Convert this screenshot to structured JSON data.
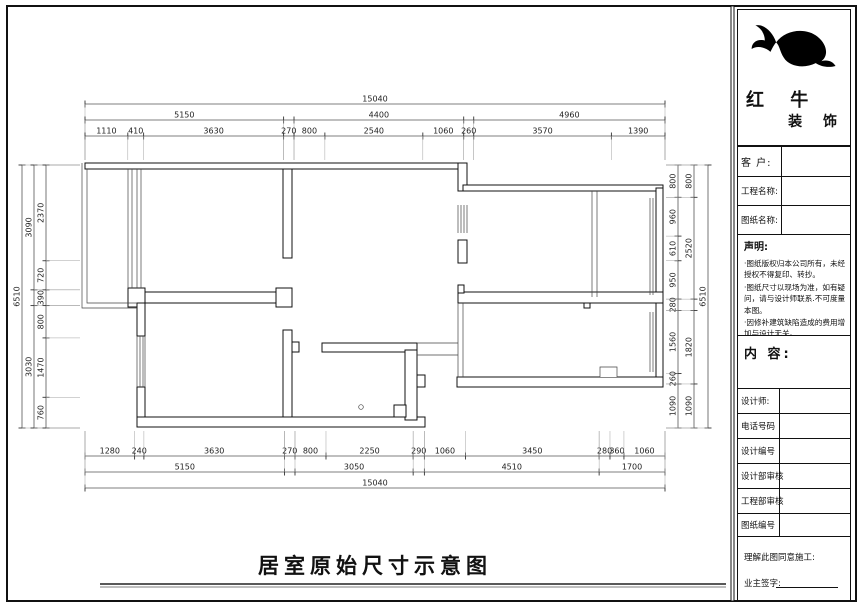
{
  "brand": {
    "line1": "红 牛",
    "line2": "装 饰"
  },
  "drawing_title": "居室原始尺寸示意图",
  "title_block": {
    "client_label": "客  户:",
    "project_label": "工程名称:",
    "drawing_label": "图纸名称:",
    "statement_heading": "声明:",
    "statement_items": [
      "·图纸版权归本公司所有，未经授权不得复印、转抄。",
      "·图纸尺寸以现场为准，如有疑问，请与设计师联系.不可度量本图。",
      "·因修补建筑缺陷造成的费用增加与设计无关。"
    ],
    "content_heading": "内 容:",
    "designer_label": "设计师:",
    "phone_label": "电话号码",
    "design_no_label": "设计编号",
    "design_review_label": "设计部审核",
    "engineering_review_label": "工程部审核",
    "drawing_no_label": "图纸编号",
    "signoff_line": "理解此图同意施工:",
    "owner_sign_label": "业主签字:"
  },
  "plan_dimensions": {
    "unit": "mm",
    "total_width": 15040,
    "total_height": 6510,
    "top": {
      "overall": [
        {
          "len": 15040,
          "label": "15040"
        }
      ],
      "groups": [
        {
          "len": 5150,
          "label": "5150"
        },
        {
          "len": 270,
          "label": ""
        },
        {
          "len": 4400,
          "label": "4400"
        },
        {
          "len": 260,
          "label": ""
        },
        {
          "len": 4960,
          "label": "4960"
        }
      ],
      "detail": [
        {
          "len": 1110,
          "label": "1110"
        },
        {
          "len": 410,
          "label": "410"
        },
        {
          "len": 3630,
          "label": "3630"
        },
        {
          "len": 270,
          "label": "270"
        },
        {
          "len": 800,
          "label": "800"
        },
        {
          "len": 2540,
          "label": "2540"
        },
        {
          "len": 1060,
          "label": "1060"
        },
        {
          "len": 260,
          "label": "260"
        },
        {
          "len": 3570,
          "label": "3570"
        },
        {
          "len": 1390,
          "label": "1390"
        }
      ]
    },
    "bottom": {
      "detail": [
        {
          "len": 1280,
          "label": "1280"
        },
        {
          "len": 240,
          "label": "240"
        },
        {
          "len": 3630,
          "label": "3630"
        },
        {
          "len": 270,
          "label": "270"
        },
        {
          "len": 800,
          "label": "800"
        },
        {
          "len": 2250,
          "label": "2250"
        },
        {
          "len": 290,
          "label": "290"
        },
        {
          "len": 1060,
          "label": "1060"
        },
        {
          "len": 3450,
          "label": "3450"
        },
        {
          "len": 280,
          "label": "280"
        },
        {
          "len": 360,
          "label": "360"
        },
        {
          "len": 1060,
          "label": "1060"
        }
      ],
      "groups": [
        {
          "len": 5150,
          "label": "5150"
        },
        {
          "len": 270,
          "label": ""
        },
        {
          "len": 3050,
          "label": "3050"
        },
        {
          "len": 290,
          "label": ""
        },
        {
          "len": 4510,
          "label": "4510"
        },
        {
          "len": 1700,
          "label": "1700"
        }
      ],
      "overall": [
        {
          "len": 14970,
          "label": "15040"
        }
      ]
    },
    "left": {
      "overall": [
        {
          "len": 6510,
          "label": "6510"
        }
      ],
      "groups": [
        {
          "len": 3090,
          "label": "3090"
        },
        {
          "len": 390,
          "label": ""
        },
        {
          "len": 3030,
          "label": "3030"
        }
      ],
      "detail": [
        {
          "len": 2370,
          "label": "2370"
        },
        {
          "len": 720,
          "label": "720"
        },
        {
          "len": 390,
          "label": "390"
        },
        {
          "len": 800,
          "label": "800"
        },
        {
          "len": 1470,
          "label": "1470"
        },
        {
          "len": 760,
          "label": "760"
        }
      ]
    },
    "right": {
      "detail": [
        {
          "len": 800,
          "label": "800"
        },
        {
          "len": 960,
          "label": "960"
        },
        {
          "len": 610,
          "label": "610"
        },
        {
          "len": 950,
          "label": "950"
        },
        {
          "len": 280,
          "label": "280"
        },
        {
          "len": 1560,
          "label": "1560"
        },
        {
          "len": 260,
          "label": "260"
        },
        {
          "len": 1090,
          "label": "1090"
        }
      ],
      "groups": [
        {
          "len": 800,
          "label": "800"
        },
        {
          "len": 2520,
          "label": "2520"
        },
        {
          "len": 280,
          "label": ""
        },
        {
          "len": 1820,
          "label": "1820"
        },
        {
          "len": 1090,
          "label": "1090"
        }
      ],
      "overall": [
        {
          "len": 6510,
          "label": "6510"
        }
      ]
    }
  }
}
